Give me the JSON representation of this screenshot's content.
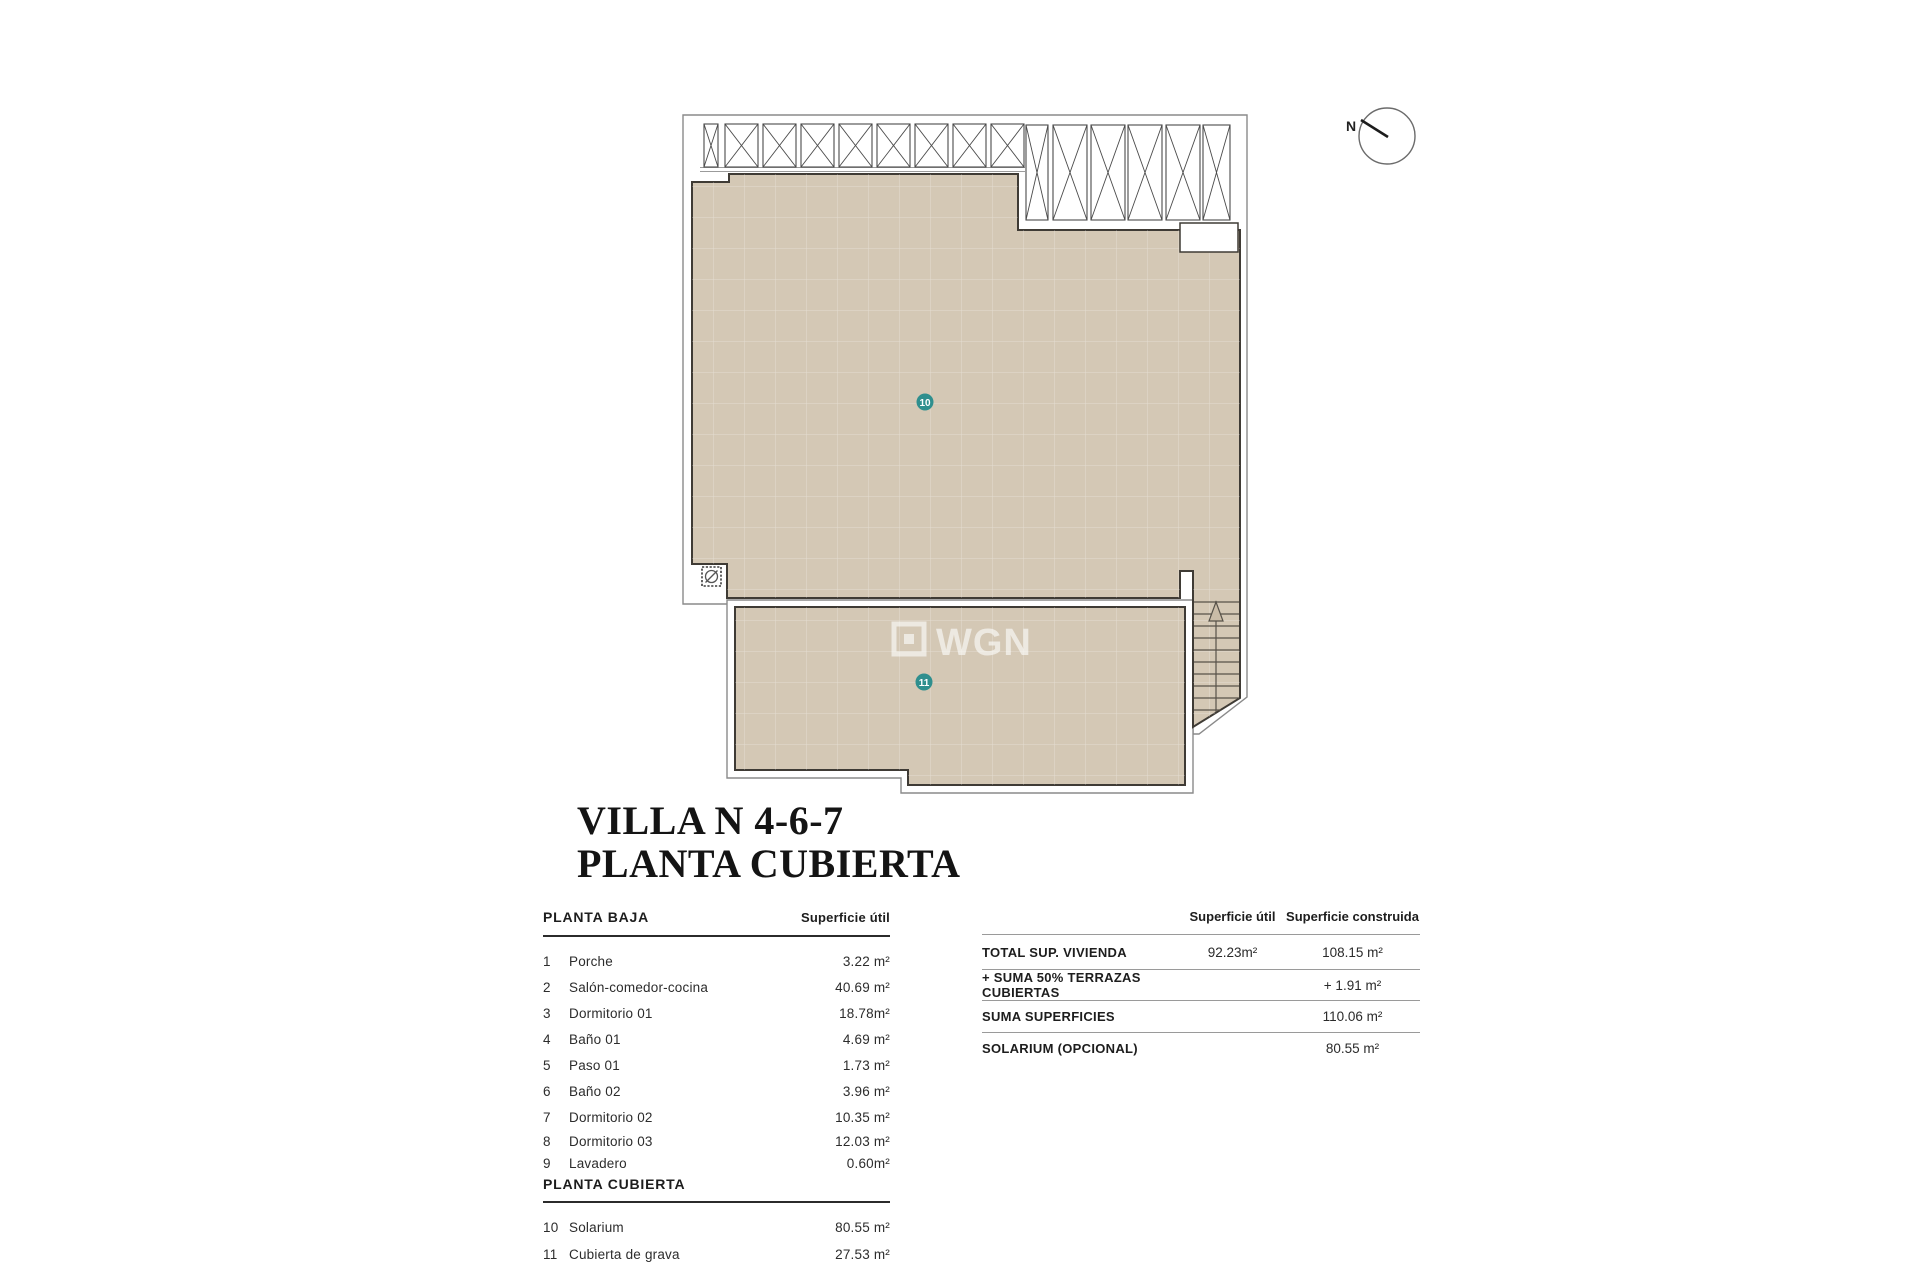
{
  "title": {
    "line1": "VILLA N 4-6-7",
    "line2": "PLANTA CUBIERTA"
  },
  "plan": {
    "compass_label": "N",
    "marker_10": "10",
    "marker_11": "11",
    "watermark_text": "WGN"
  },
  "colors": {
    "roof_fill": "#d4c8b5",
    "roof_outline": "#3f3b35",
    "footprint_outline": "#8a8a8a",
    "marker_teal": "#2f8f8e",
    "watermark": "rgba(255,255,255,0.6)"
  },
  "left_table": {
    "section1_header": "PLANTA BAJA",
    "col_header": "Superficie útil",
    "section1_rows": [
      {
        "num": "1",
        "name": "Porche",
        "area": "3.22 m²"
      },
      {
        "num": "2",
        "name": "Salón-comedor-cocina",
        "area": "40.69 m²"
      },
      {
        "num": "3",
        "name": "Dormitorio 01",
        "area": "18.78m²"
      },
      {
        "num": "4",
        "name": "Baño 01",
        "area": "4.69 m²"
      },
      {
        "num": "5",
        "name": "Paso 01",
        "area": "1.73 m²"
      },
      {
        "num": "6",
        "name": "Baño 02",
        "area": "3.96 m²"
      },
      {
        "num": "7",
        "name": "Dormitorio 02",
        "area": "10.35 m²"
      },
      {
        "num": "8",
        "name": "Dormitorio 03",
        "area": "12.03 m²"
      },
      {
        "num": "9",
        "name": "Lavadero",
        "area": "0.60m²"
      }
    ],
    "section2_header": "PLANTA CUBIERTA",
    "section2_rows": [
      {
        "num": "10",
        "name": "Solarium",
        "area": "80.55 m²"
      },
      {
        "num": "11",
        "name": "Cubierta de grava",
        "area": "27.53 m²"
      }
    ]
  },
  "summary_table": {
    "col1_header": "Superficie útil",
    "col2_header": "Superficie construida",
    "rows": [
      {
        "label": "TOTAL SUP. VIVIENDA",
        "util": "92.23m²",
        "construida": "108.15 m²"
      },
      {
        "label": "+ SUMA 50% TERRAZAS CUBIERTAS",
        "util": "",
        "construida": "+ 1.91 m²"
      },
      {
        "label": "SUMA SUPERFICIES",
        "util": "",
        "construida": "110.06 m²"
      },
      {
        "label": "SOLARIUM (OPCIONAL)",
        "util": "",
        "construida": "80.55 m²"
      }
    ]
  }
}
